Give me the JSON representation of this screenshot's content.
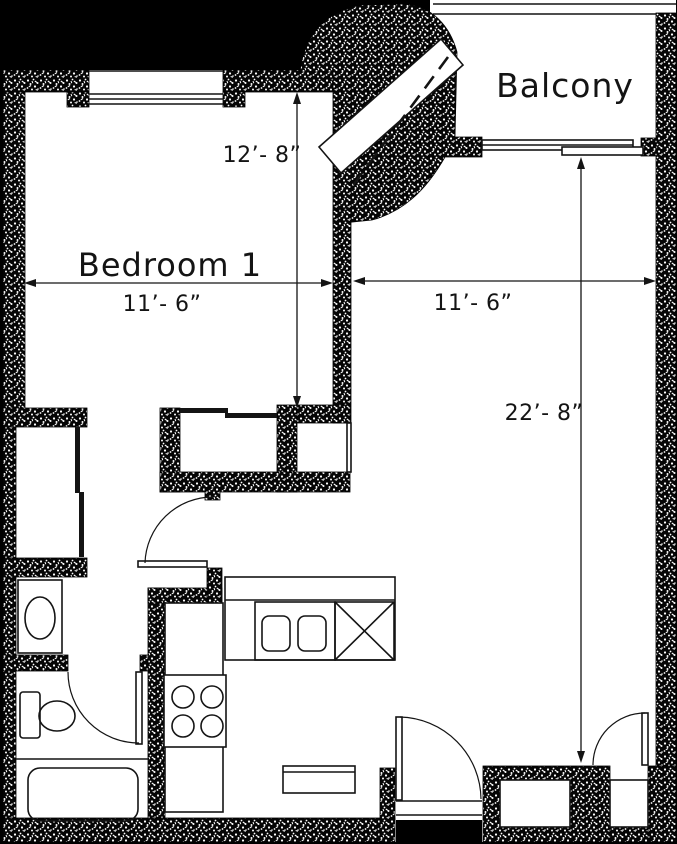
{
  "page": {
    "background": "#000000"
  },
  "plan": {
    "rooms": {
      "bedroom_label": "Bedroom 1",
      "balcony_label": "Balcony"
    },
    "dimensions": {
      "bedroom_height": "12’- 8”",
      "bedroom_width": "11’- 6”",
      "living_width": "11’- 6”",
      "living_height": "22’- 8”"
    },
    "colors": {
      "wall": "#000000",
      "floor": "#ffffff",
      "line": "#141414",
      "text": "#141414",
      "outside": "#000000"
    }
  }
}
